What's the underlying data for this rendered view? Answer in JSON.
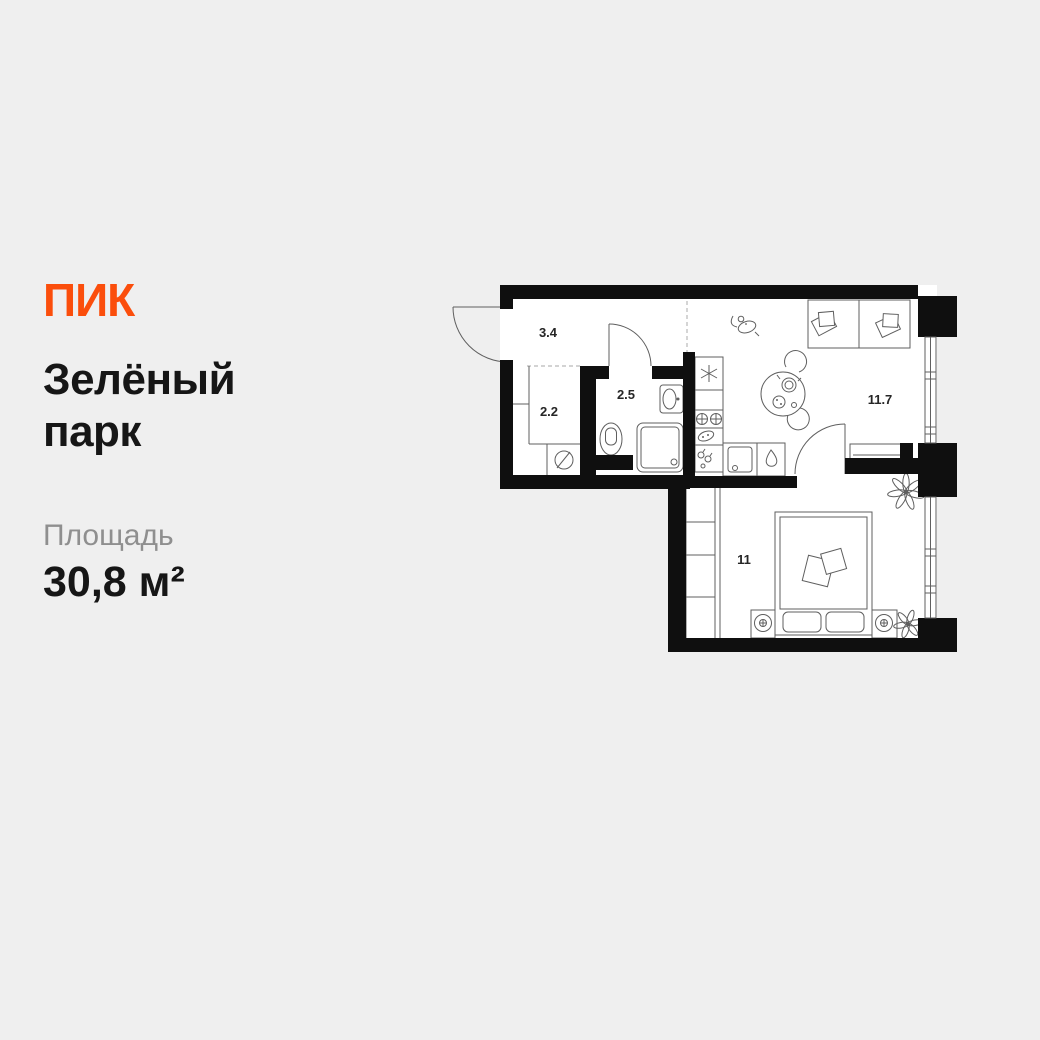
{
  "brand": {
    "logo": "ПИК",
    "accent_color": "#FB4E0C"
  },
  "project": {
    "title_line1": "Зелёный",
    "title_line2": "парк"
  },
  "area": {
    "label": "Площадь",
    "value": "30,8 м²"
  },
  "plan": {
    "rooms": [
      {
        "id": "hallway",
        "area": "3.4"
      },
      {
        "id": "storage",
        "area": "2.2"
      },
      {
        "id": "bathroom",
        "area": "2.5"
      },
      {
        "id": "kitchen-living",
        "area": "11.7"
      },
      {
        "id": "bedroom",
        "area": "11"
      }
    ],
    "colors": {
      "wall": "#0f0f0f",
      "furniture_line": "#5f5f5f",
      "floor": "#ffffff",
      "background": "#efefef",
      "zone_dash": "#b9b9b9"
    }
  }
}
